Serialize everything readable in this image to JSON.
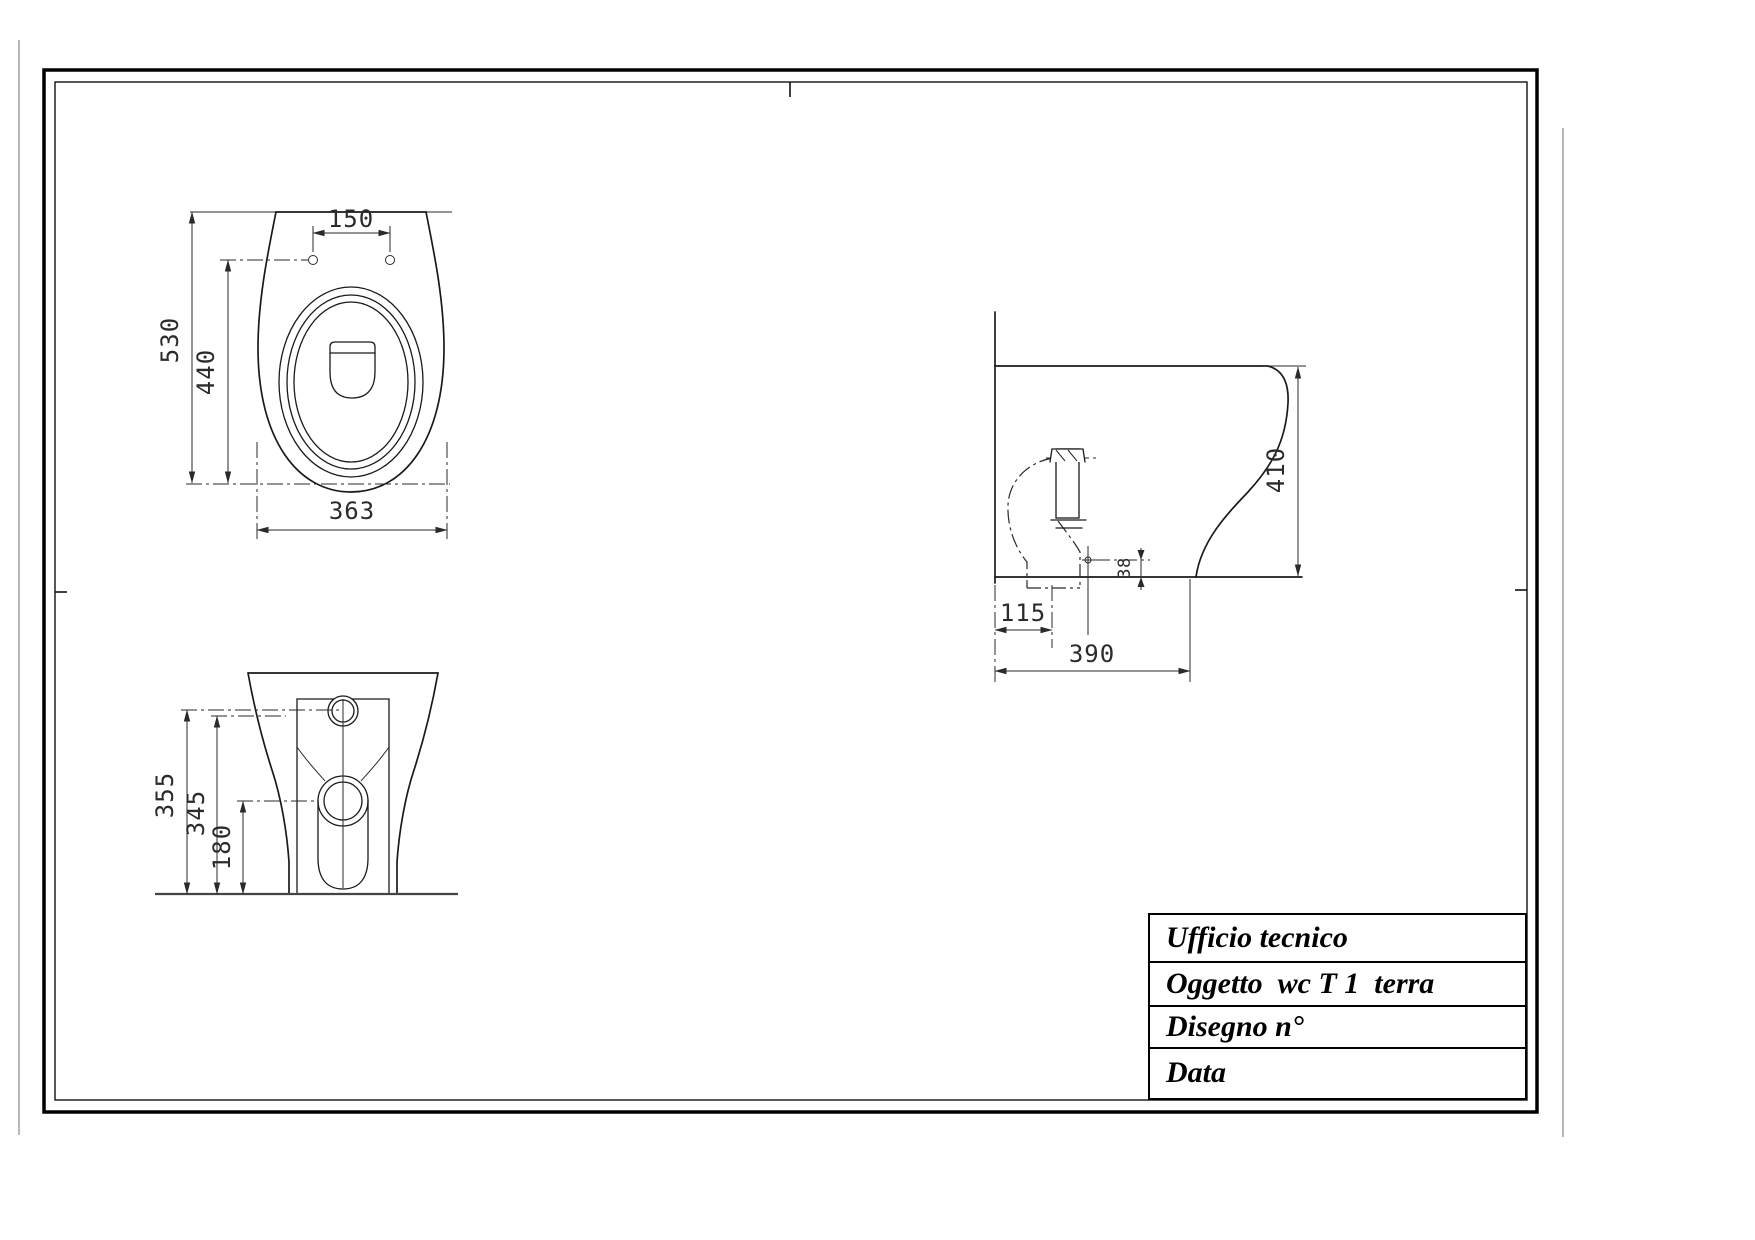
{
  "title_block": {
    "rows": [
      {
        "label": "Ufficio tecnico"
      },
      {
        "label": "Oggetto  wc T 1  terra"
      },
      {
        "label": "Disegno n°"
      },
      {
        "label": "Data"
      }
    ]
  },
  "drawing": {
    "object": "wc T 1 terra (floor-standing toilet)",
    "views": {
      "plan": {
        "dims": {
          "bolt_hole_spacing": "150",
          "overall_length": "530",
          "holes_to_front": "440",
          "overall_width": "363"
        }
      },
      "side": {
        "dims": {
          "overall_height": "410",
          "wall_to_trap": "115",
          "overall_depth": "390",
          "outlet_center_height": "38"
        }
      },
      "rear": {
        "dims": {
          "inlet_height": "355",
          "secondary_height": "345",
          "outlet_height": "180"
        }
      }
    }
  },
  "colors": {
    "ink": "#1a1a1a",
    "dim_line": "#2a2a2a",
    "background": "#ffffff"
  }
}
